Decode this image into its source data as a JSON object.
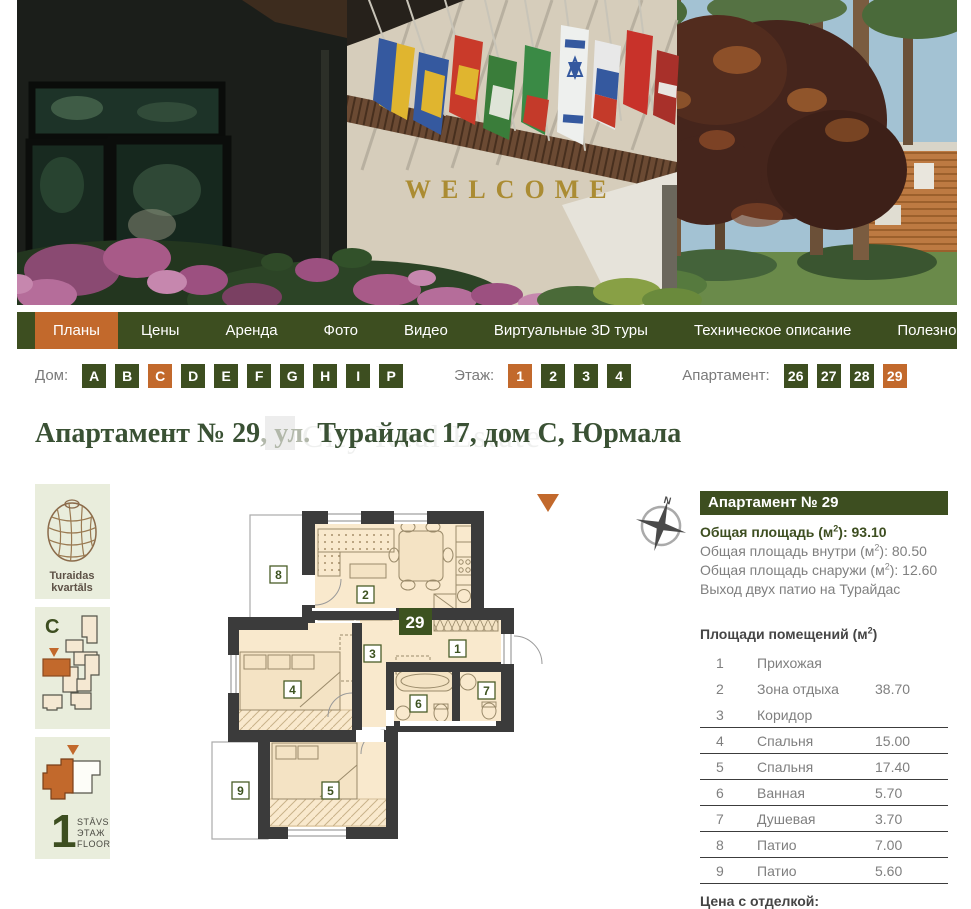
{
  "hero": {
    "welcome": "WELCOME"
  },
  "nav": {
    "items": [
      {
        "label": "Планы",
        "on": true
      },
      {
        "label": "Цены"
      },
      {
        "label": "Аренда"
      },
      {
        "label": "Фото"
      },
      {
        "label": "Видео"
      },
      {
        "label": "Виртуальные 3D туры"
      },
      {
        "label": "Техническое описание"
      },
      {
        "label": "Полезное"
      },
      {
        "label": "Офисы продаж"
      }
    ]
  },
  "filters": {
    "house_label": "Дом:",
    "houses": [
      {
        "v": "A"
      },
      {
        "v": "B"
      },
      {
        "v": "C",
        "on": true
      },
      {
        "v": "D"
      },
      {
        "v": "E"
      },
      {
        "v": "F"
      },
      {
        "v": "G"
      },
      {
        "v": "H"
      },
      {
        "v": "I"
      },
      {
        "v": "P"
      }
    ],
    "floor_label": "Этаж:",
    "floors": [
      {
        "v": "1",
        "on": true
      },
      {
        "v": "2"
      },
      {
        "v": "3"
      },
      {
        "v": "4"
      }
    ],
    "apartment_label": "Апартамент:",
    "apartments": [
      {
        "v": "26"
      },
      {
        "v": "27"
      },
      {
        "v": "28"
      },
      {
        "v": "29",
        "on": true
      }
    ]
  },
  "title": {
    "apartment": "Апартамент № 29",
    "street_prefix": ", ул. ",
    "address": "Турайдас 17, дом С, Юрмала",
    "watermark": "City Real Estate"
  },
  "sidebar": {
    "project_line1": "Turaidas",
    "project_line2": "kvartāls",
    "building": "C",
    "floor_number": "1",
    "floor_word1": "STĀVS",
    "floor_word2": "ЭТАЖ",
    "floor_word3": "FLOOR"
  },
  "plan": {
    "badge": "29",
    "compass": "N",
    "room_numbers": {
      "r1": "1",
      "r2": "2",
      "r3": "3",
      "r4": "4",
      "r5": "5",
      "r6": "6",
      "r7": "7",
      "r8": "8",
      "r9": "9"
    }
  },
  "details": {
    "header": "Апартамент № 29",
    "areas": [
      {
        "label": "Общая площадь (м",
        "sup": "2",
        "rest": "): 93.10"
      },
      {
        "label": "Общая площадь внутри (м",
        "sup": "2",
        "rest": "): 80.50"
      },
      {
        "label": "Общая площадь снаружи (м",
        "sup": "2",
        "rest": "): 12.60"
      },
      {
        "label": "Выход двух патио на Турайдас",
        "sup": "",
        "rest": ""
      }
    ],
    "table_title": {
      "label": "Площади помещений (м",
      "sup": "2",
      "rest": ")"
    },
    "rooms": [
      {
        "num": "1",
        "name": "Прихожая",
        "area": ""
      },
      {
        "num": "2",
        "name": "Зона отдыха",
        "area": "38.70"
      },
      {
        "num": "3",
        "name": "Коридор",
        "area": ""
      },
      {
        "num": "4",
        "name": "Спальня",
        "area": "15.00"
      },
      {
        "num": "5",
        "name": "Спальня",
        "area": "17.40"
      },
      {
        "num": "6",
        "name": "Ванная",
        "area": "5.70"
      },
      {
        "num": "7",
        "name": "Душевая",
        "area": "3.70"
      },
      {
        "num": "8",
        "name": "Патио",
        "area": "7.00"
      },
      {
        "num": "9",
        "name": "Патио",
        "area": "5.60"
      }
    ],
    "price_label": "Цена с отделкой:"
  }
}
